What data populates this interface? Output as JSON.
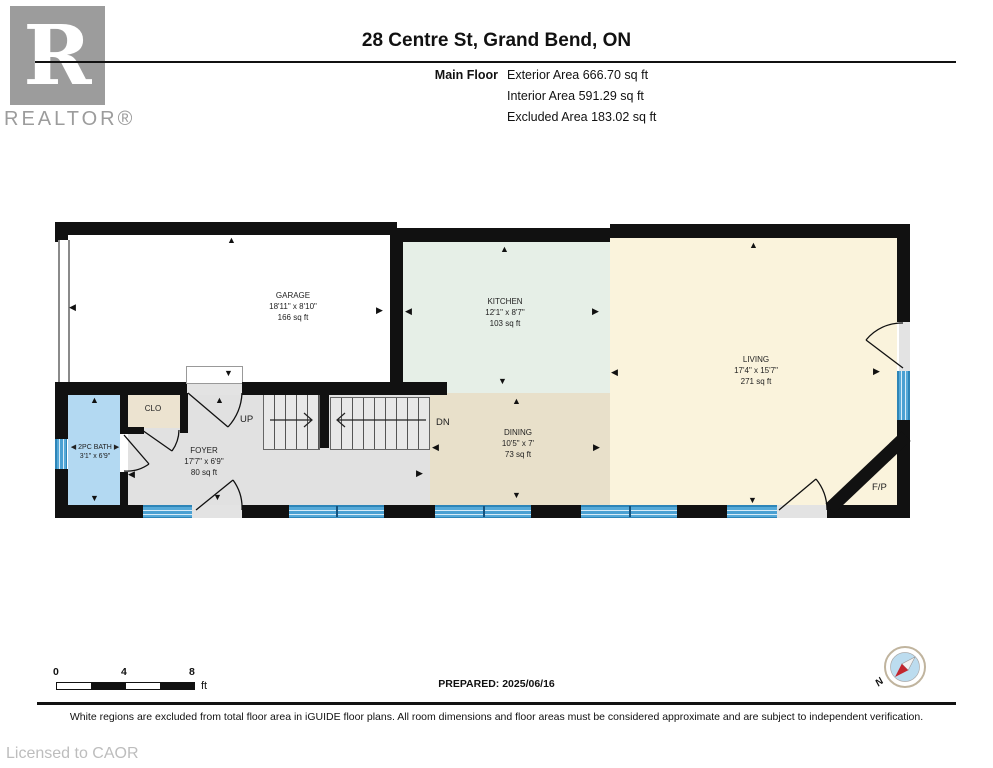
{
  "header": {
    "title": "28 Centre St, Grand Bend, ON",
    "floor_label": "Main Floor",
    "area_lines": [
      "Exterior Area 666.70 sq ft",
      "Interior Area 591.29 sq ft",
      "Excluded Area 183.02 sq ft"
    ],
    "logo_letter": "R",
    "logo_label": "REALTOR®"
  },
  "rooms": {
    "garage": {
      "name": "GARAGE",
      "dims": "18'11\" x 8'10\"",
      "area": "166 sq ft"
    },
    "kitchen": {
      "name": "KITCHEN",
      "dims": "12'1\" x 8'7\"",
      "area": "103 sq ft"
    },
    "living": {
      "name": "LIVING",
      "dims": "17'4\" x 15'7\"",
      "area": "271 sq ft"
    },
    "dining": {
      "name": "DINING",
      "dims": "10'5\" x 7'",
      "area": "73 sq ft"
    },
    "foyer": {
      "name": "FOYER",
      "dims": "17'7\" x 6'9\"",
      "area": "80 sq ft"
    },
    "bath": {
      "name": "2PC BATH",
      "dims": "3'1\" x 6'9\""
    },
    "closet": {
      "name": "CLO"
    }
  },
  "labels": {
    "up": "UP",
    "dn": "DN",
    "fireplace": "F/P",
    "north": "N"
  },
  "glyphs": {
    "up": "▲",
    "down": "▼",
    "left": "◀",
    "right": "▶"
  },
  "scale": {
    "t0": "0",
    "t4": "4",
    "t8": "8",
    "unit": "ft"
  },
  "footer": {
    "prepared": "PREPARED: 2025/06/16",
    "disclaimer": "White regions are excluded from total floor area in iGUIDE floor plans. All room dimensions and floor areas must be considered approximate and are subject to independent verification.",
    "license": "Licensed to CAOR"
  },
  "colors": {
    "wall": "#111111",
    "kitchen": "#e6efe7",
    "living": "#faf3dc",
    "dining": "#e8e0ca",
    "foyer": "#e1e1e1",
    "bath": "#b3d9f2",
    "closet": "#ece3d0",
    "garage": "#ffffff",
    "window": "#4aa0d2",
    "compass_red": "#c2262e",
    "compass_blue": "#bcdcef"
  }
}
